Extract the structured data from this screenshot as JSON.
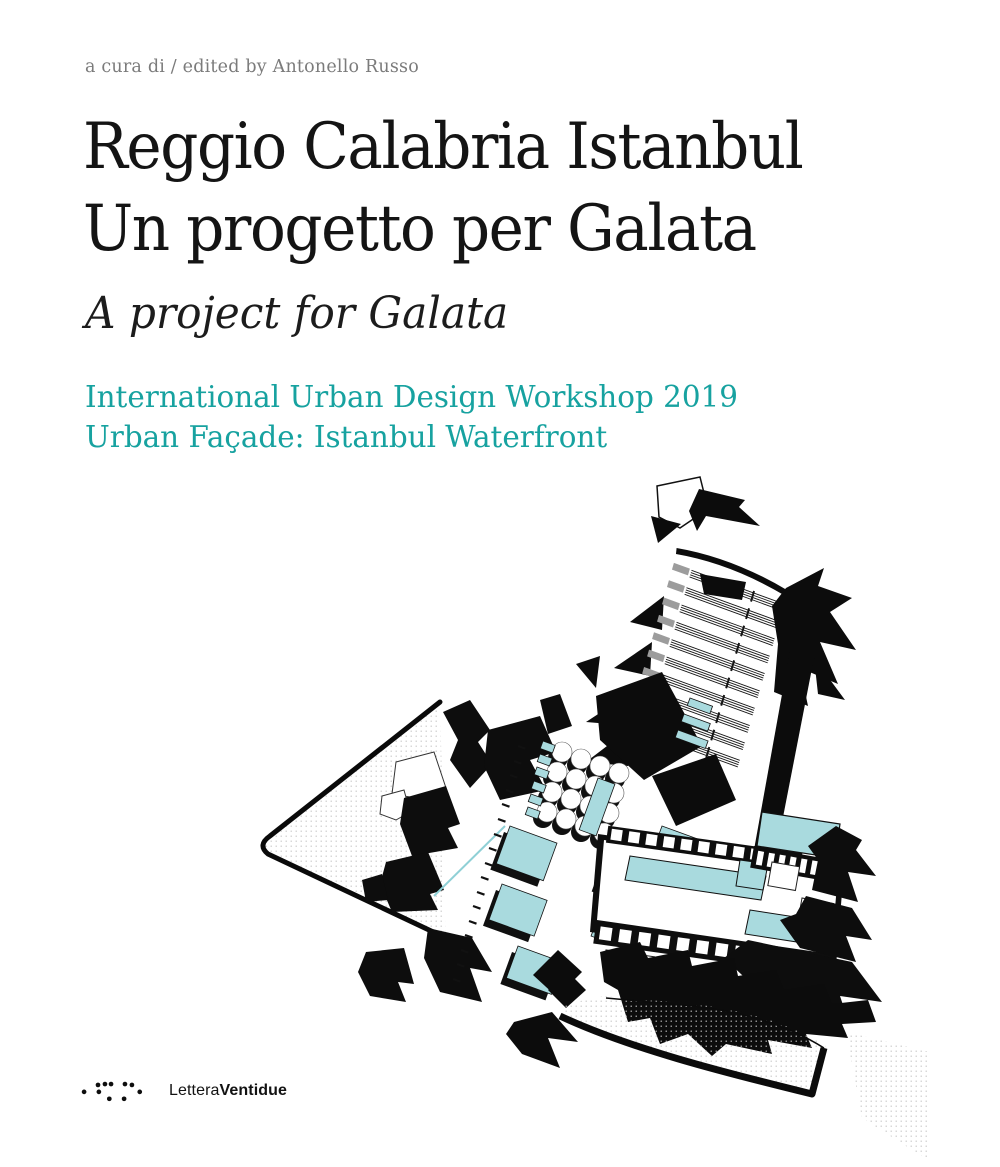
{
  "cover": {
    "editor_line": "a cura di / edited by Antonello Russo",
    "title_line1": "Reggio Calabria Istanbul",
    "title_line2": "Un progetto per Galata",
    "subtitle": "A project for Galata",
    "workshop_line1": "International Urban Design Workshop 2019",
    "workshop_line2": "Urban Façade: Istanbul Waterfront"
  },
  "publisher": {
    "name_regular": "Lettera",
    "name_bold": "Ventidue"
  },
  "colors": {
    "teal_text": "#17a2a0",
    "plan_teal": "#a9dade",
    "plan_gray": "#9c9c9c",
    "ink": "#141414",
    "muted_gray": "#7b7b7b",
    "background": "#ffffff"
  }
}
